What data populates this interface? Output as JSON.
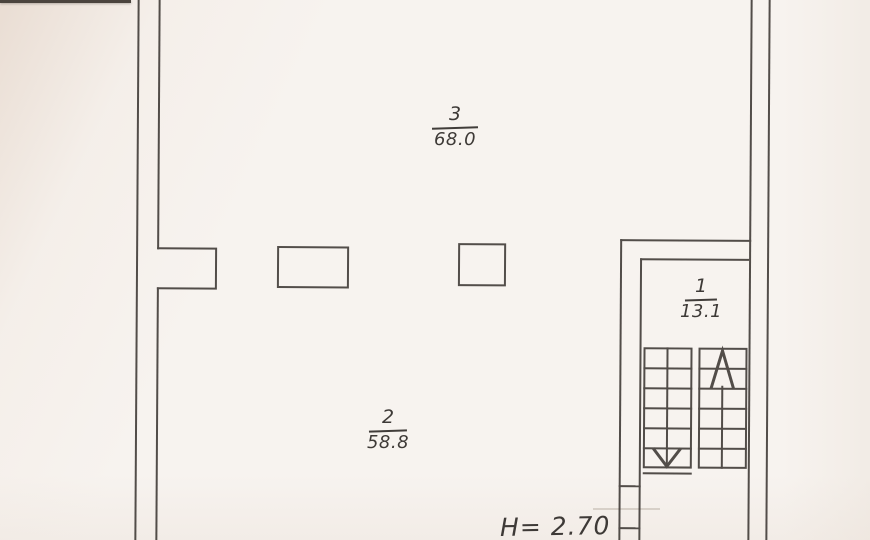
{
  "plan": {
    "rooms": [
      {
        "number": "3",
        "area": "68.0"
      },
      {
        "number": "2",
        "area": "58.8"
      },
      {
        "number": "1",
        "area": "13.1"
      }
    ],
    "height_label": "H= 2.70",
    "colors": {
      "paper": "#f7f3ef",
      "ink": "#46413d",
      "pencil": "#cdc5bc",
      "paper_edge": "#4b443e"
    }
  }
}
